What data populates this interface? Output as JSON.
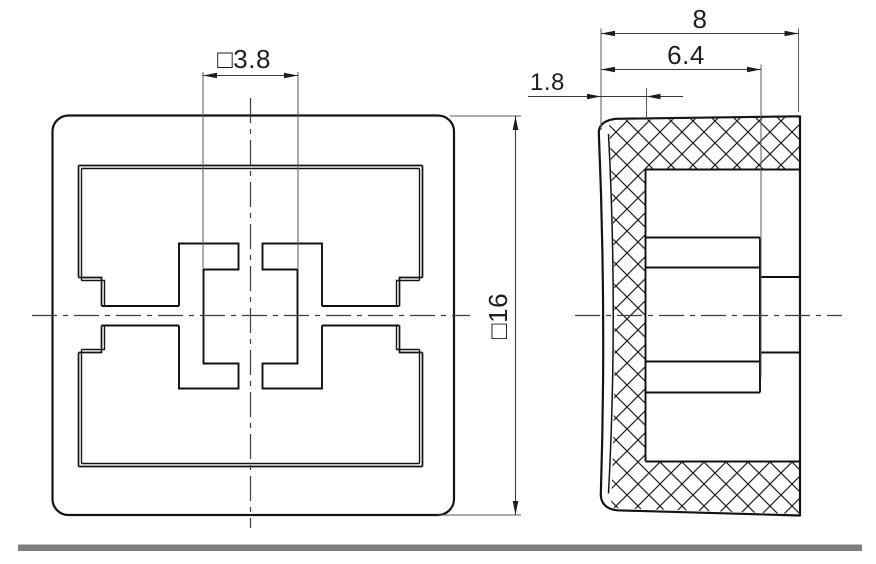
{
  "drawing": {
    "title": "button-cap technical drawing, two views",
    "front_view": {
      "name": "front view",
      "dim_square_hole": "□3.8",
      "dim_outer_square": "□16"
    },
    "side_view": {
      "name": "side section view",
      "dim_overall_depth": "8",
      "dim_inner_depth": "6.4",
      "dim_wall_thickness": "1.8"
    },
    "colors": {
      "line": "#141414",
      "thin_line": "#3a3a3a",
      "divider_bar": "#7d7d7d",
      "background": "#ffffff"
    }
  }
}
